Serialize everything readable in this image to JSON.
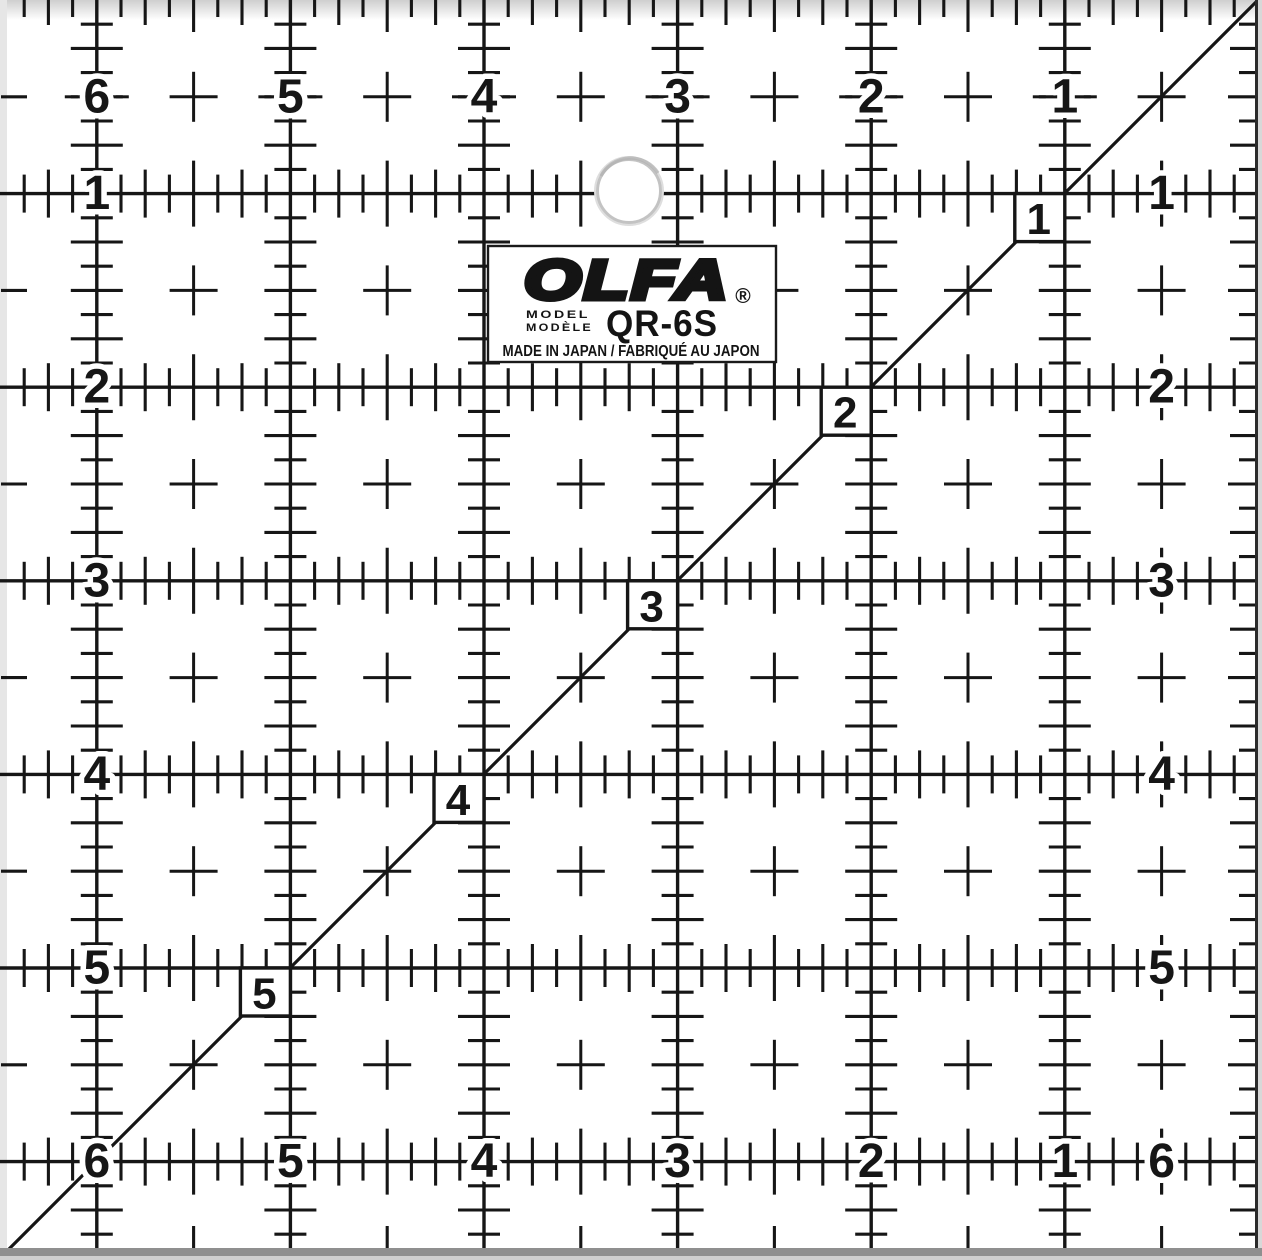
{
  "product": {
    "brand_logo": "OLFA",
    "registered_mark": "®",
    "model_word_en": "MODEL",
    "model_word_fr": "MODÈLE",
    "model_number": "QR-6S",
    "origin_line": "MADE IN JAPAN / FABRIQUÉ AU JAPON"
  },
  "ruler": {
    "top_edge_numbers": [
      "6",
      "5",
      "4",
      "3",
      "2",
      "1"
    ],
    "bottom_edge_numbers": [
      "6",
      "5",
      "4",
      "3",
      "2",
      "1"
    ],
    "left_edge_numbers": [
      "1",
      "2",
      "3",
      "4",
      "5",
      "6"
    ],
    "right_edge_numbers": [
      "1",
      "2",
      "3",
      "4",
      "5",
      "6"
    ],
    "diagonal_numbers": [
      "1",
      "2",
      "3",
      "4",
      "5"
    ],
    "colors": {
      "marking": "#161616",
      "background": "#ffffff",
      "label_background": "#ffffff",
      "label_border": "#1a1a1a",
      "bottom_edge_shadow": "#8f8f8f",
      "side_edge_shade": "#e6e6e6",
      "hole_rim": "#c3c3c3"
    }
  }
}
